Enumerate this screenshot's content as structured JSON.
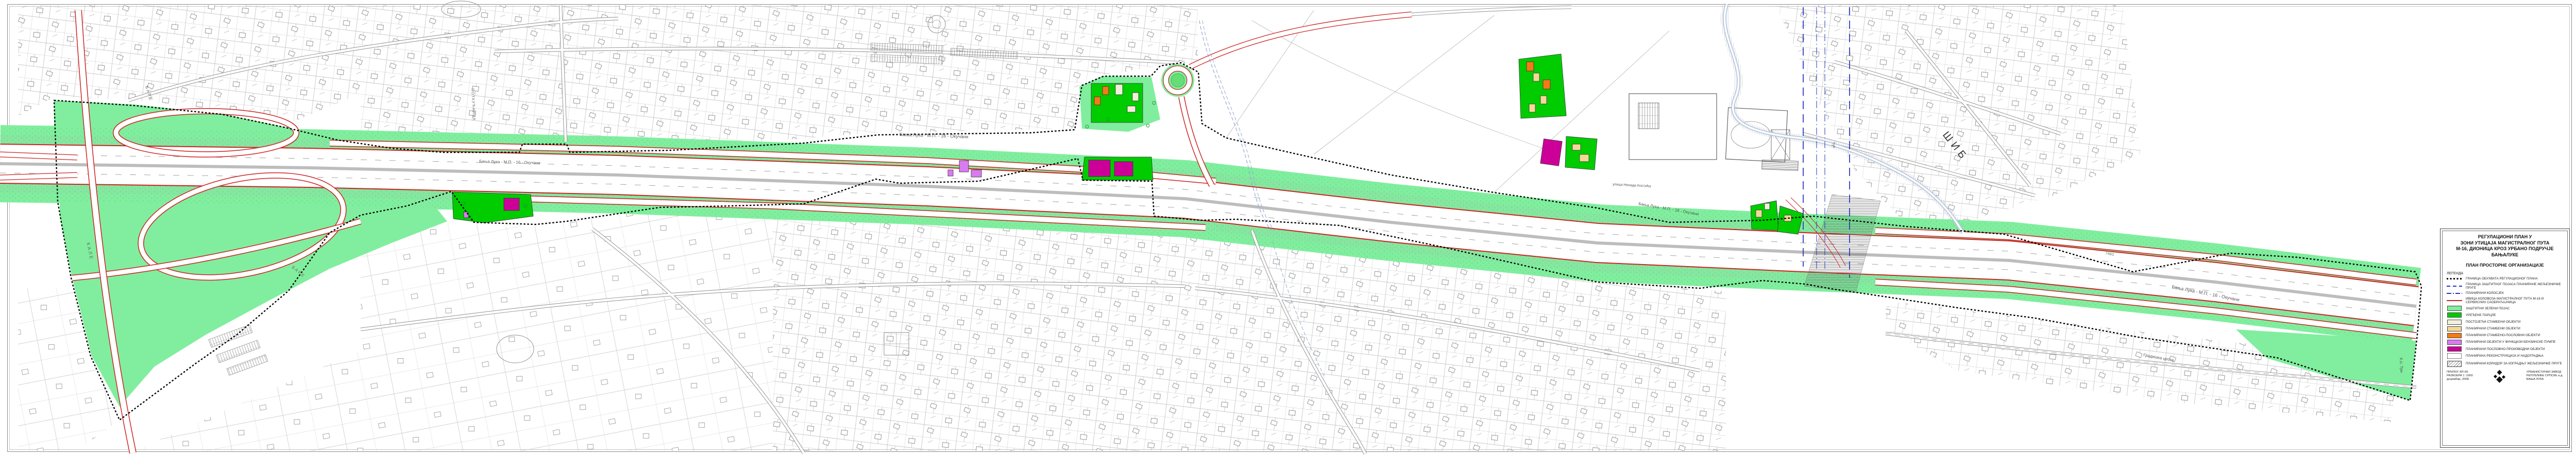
{
  "colors": {
    "mint_green": "#80ee9e",
    "bright_green": "#00cc00",
    "existing_residential": "#f2f0dc",
    "planned_residential": "#f5d898",
    "planned_mixed_use": "#f57917",
    "petrol_station_violet": "#d97bf0",
    "business_production_magenta": "#cc0099",
    "road_edge_red": "#cc2222",
    "railway_blue": "#2233bb",
    "plan_boundary_black": "#000000"
  },
  "map": {
    "highway_label": "Бања Лука - М.П. - 16 - Окучани",
    "labels": {
      "kale": "КАЛЕ",
      "bare_upper": "БАРЕ",
      "bare_lower": "БАРЕ",
      "potkucnica": "ПОТКУЋНИЦА",
      "sib": "ШИБ",
      "tuk": "Тук",
      "nenad_kostic_street": "улица Ненада Костића",
      "gradiska_cesta": "Градишка цеста",
      "ko_trn": "К.о. Трн",
      "parcel_749": "749/2"
    }
  },
  "title_block": {
    "title_lines": [
      "РЕГУЛАЦИОНИ ПЛАН У",
      "ЗОНИ УТИЦАЈА МАГИСТРАЛНОГ ПУТА",
      "М-16, ДИОНИЦА КРОЗ УРБАНО ПОДРУЧЈЕ",
      "БАЊАЛУКЕ"
    ],
    "subtitle": "ПЛАН ПРОСТОРНЕ ОРГАНИЗАЦИЈЕ",
    "legend_heading": "ЛЕГЕНДА",
    "line_items": [
      {
        "label": "ГРАНИЦА ОБУХВАТА РЕГУЛАЦИОНОГ ПЛАНА"
      },
      {
        "label": "ГРАНИЦА ЗАШТИТНОГ ПОЈАСА ПЛАНИРАНЕ ЖЕЉЕЗНИЧКЕ  ПРУГЕ"
      },
      {
        "label": "ПЛАНИРАНИ КОЛОСЈЕК"
      },
      {
        "label": "ИВИЦА КОЛОВОЗА МАГИСТРАЛНОГ ПУТА М-16 И СЕРВИСНИХ САОБРАЋАЈНИЦА"
      }
    ],
    "area_items": [
      {
        "label": "ЗАШТИТНИ ЗЕЛЕНИ ПОЈАС",
        "color": "#80ee9e"
      },
      {
        "label": "УРЕЂЕНЕ ПАРЦЛЕ",
        "color": "#00cc00"
      },
      {
        "label": "ПОСТОЈЕЋИ СТАМБЕНИ ОБЈЕКТИ",
        "color": "#f2f0dc"
      },
      {
        "label": "ПЛАНИРАНИ СТАМБЕНИ ОБЈЕКТИ",
        "color": "#f5d898"
      },
      {
        "label": "ПЛАНИРАНИ СТАМБЕНО-ПОСЛОВНИ ОБЈЕКТИ",
        "color": "#f57917"
      },
      {
        "label": "ПЛАНИРАНИ ОБЈЕКТИ У ФУНКЦИЈИ БЕНЗИНСКЕ ПУМПЕ",
        "color": "#d97bf0"
      },
      {
        "label": "ПЛАНИРАНИ ПОСЛОВНО-ПРОИЗВОДНИ ОБЈЕКТИ",
        "color": "#cc0099"
      }
    ],
    "box_items": [
      {
        "label": "ПЛАНИРАНА РЕКОНСТРУКЦИЈА И НАДОГРАДЊА"
      },
      {
        "label": "ПЛАНИРАНИ КОРИДОР ЗА ИЗГРАДЊУ ЖЕЉЕЗНИЧКЕ ПРУГЕ"
      }
    ],
    "footer": {
      "attachment_no": "ПРИЛОГ БР.:06",
      "scale": "РАЗМЈЕРА  1 :1000",
      "date": "децембар, 2008.",
      "org_lines": [
        "УРБАНИСТИЧКИ ЗАВОД",
        "РЕПУБЛИКЕ СРПСКЕ а.д.",
        "БАЊА ЛУКА"
      ]
    }
  }
}
